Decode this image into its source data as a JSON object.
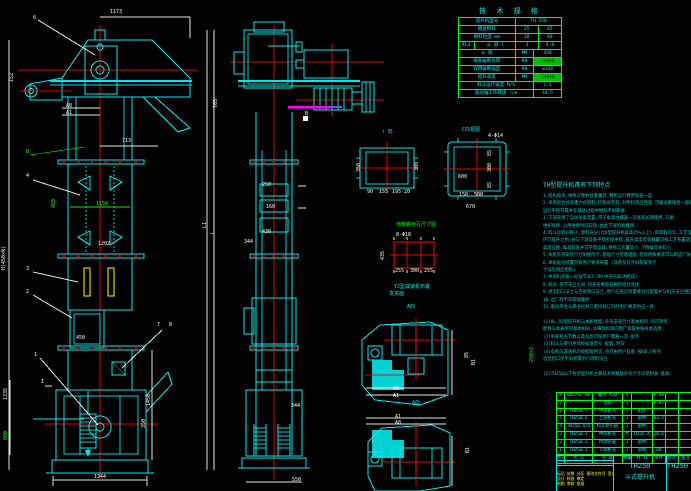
{
  "spec_table": {
    "title": "技 术 规 格",
    "rows": [
      {
        "cells": [
          {
            "t": "提升机型号",
            "f": 5
          },
          {
            "t": "TH 250",
            "f": 4
          }
        ]
      },
      {
        "cells": [
          {
            "t": "输送物料",
            "f": 5
          },
          {
            "t": "25",
            "f": 2
          },
          {
            "t": "45",
            "f": 2
          }
        ]
      },
      {
        "cells": [
          {
            "t": "物料粒度 mm",
            "f": 5
          },
          {
            "t": "30",
            "f": 2
          },
          {
            "t": "40",
            "f": 2
          }
        ]
      },
      {
        "cells": [
          {
            "t": "料斗",
            "f": 1.4
          },
          {
            "t": "斗 容 l",
            "f": 3.6
          },
          {
            "t": "3",
            "f": 2
          },
          {
            "t": "4.8",
            "f": 2
          }
        ]
      },
      {
        "cells": [
          {
            "t": "斗 距",
            "f": 5
          },
          {
            "t": "MM",
            "f": 1.6
          },
          {
            "t": "450",
            "f": 2.4
          }
        ]
      },
      {
        "cells": [
          {
            "t": "链条破断负荷",
            "f": 5
          },
          {
            "t": "KN",
            "f": 1.6
          },
          {
            "t": "25000",
            "f": 2.4,
            "hl": true
          }
        ]
      },
      {
        "cells": [
          {
            "t": "许用破断强度",
            "f": 5
          },
          {
            "t": "KN",
            "f": 1.6
          },
          {
            "t": "≥320",
            "f": 2.4
          }
        ]
      },
      {
        "cells": [
          {
            "t": "提升高度",
            "f": 5
          },
          {
            "t": "MM",
            "f": 1.6
          },
          {
            "t": "14040",
            "f": 2.4,
            "hl": true
          }
        ]
      },
      {
        "cells": [
          {
            "t": "料斗运行速度 M/S",
            "f": 6.6
          },
          {
            "t": "1.2",
            "f": 2.4
          }
        ]
      },
      {
        "cells": [
          {
            "t": "驱动轴工作转速 r/m",
            "f": 6.6
          },
          {
            "t": "44.5",
            "f": 2.4
          }
        ]
      }
    ]
  },
  "notes": {
    "header": "TH型提升机具有下列特点",
    "lines": [
      "1.结构简单,维修方便并且重量轻,整机运行费用较低一些",
      "2.采用混合式或重力式卸料,挖取式装料,对物料适应性强 可输送磨琢性一般的物料,",
      "  运行平稳可靠并在输送过程中物料不易撒漏",
      "3.下部采用了自动张紧装置,带子张紧由螺旋一次张紧长期使用,方便",
      "  维护保养,占用维修时间较短,由此节省检修费用",
      "4.料斗运转间隙小,卸料充分(比D型提升机提高25%以上),装卸料均匀,工艺流程中可作中间",
      "  环节提升之用,并与下游设备平稳衔接中转,提升高度及装载量可按工艺布置选择有较",
      "  高适应性,噪音较低并可平稳运转,维修工作量较小 下降噪音亦较小",
      "5.本机外形安装尺寸如图所示,基础尺寸见基础图,若有特殊要求可与制造厂协商订货",
      "6.本机驱动装置可按用户要求布置            (其余型号外形及安装尺",
      "  寸详见相应图纸)",
      "7.中部机壳每一标准节长2.5M(中部壳高3M组成)",
      "8.机壳 各节法兰之间 均夹有橡胶石棉垫密封连接",
      "9.进出料口法兰与连接管口法兰,用户应按实际需要另行配置并与机壳法兰相匹配连接",
      "10.出厂时不带基础螺栓",
      "11.驱动平台与梯子栏杆二者均按订货时用户要求供应一并",
      "",
      "(1)HL,DZ型提升机与本机性能,外形安装尺寸基本相同 均可参考,",
      "   配件与本表所列基本相同,详细资料请向我厂索取并按样本选用:",
      "(2)中部机壳节数以及总高可按用户需要一次-配齐",
      "(3)料斗与牵引件均按标准型号 配套 供货",
      "(4)电机与减速机均按配套供货,也可由用户自备 按GB,Y系列",
      "   选型后口径不同者需另行改制法兰",
      "",
      "(5)TH250以下各型提升机主要技术参数及外形尺寸详见附表 备索."
    ]
  },
  "parts_table": {
    "col_flex": [
      0.55,
      2.0,
      2.2,
      0.6,
      1.5,
      0.9,
      0.9,
      1.0
    ],
    "rows": [
      [
        "8",
        "GB5782-86",
        "螺栓 M20",
        "4",
        "",
        "0.08",
        "",
        ""
      ],
      [
        "7",
        "",
        "垫圈",
        "1",
        "",
        "0.05",
        "",
        ""
      ],
      [
        "6",
        "TH250.7",
        "中部机壳",
        "1",
        "组焊",
        "",
        "",
        ""
      ],
      [
        "5",
        "TH250.6",
        "上部机壳",
        "1",
        "部件",
        "83.5",
        "",
        ""
      ],
      [
        "4",
        "TH250.4/5",
        "料斗牵引链",
        "1",
        "部件",
        "",
        "",
        ""
      ],
      [
        "3",
        "TH250.3",
        "中间机壳",
        "M",
        "Q235-A",
        "20.6",
        "",
        ""
      ],
      [
        "2",
        "TH250.2",
        "传动装置",
        "1",
        "部件",
        "",
        "",
        ""
      ],
      [
        "1",
        "TH250.1",
        "下部机壳",
        "1",
        "部件",
        "88",
        "",
        ""
      ]
    ],
    "header": [
      "件号",
      "代 号",
      "名 称",
      "数量",
      "材 料",
      "单件",
      "总计",
      "备注"
    ]
  },
  "title_block": {
    "model": "TH250",
    "product": "斗式提升机",
    "right_model": "TH250",
    "rev_row": "标记 处数 分区 更改文件号 签名 日期",
    "sign_row1": "设计  校核  审定",
    "sign_row2": "制图  审核  批准"
  },
  "colors": {
    "line_cyan": "#00e8e8",
    "centerline_red": "#ff0000",
    "accent_green": "#00ff00",
    "accent_yellow": "#ffff00",
    "highlight_magenta": "#ff00ff",
    "background": "#000000"
  },
  "annotations": [
    {
      "x": 33,
      "y": 16,
      "t": "6",
      "c": "w"
    },
    {
      "x": 110,
      "y": 10,
      "t": "1173",
      "c": "w"
    },
    {
      "x": 10,
      "y": 82,
      "t": "152",
      "c": "w",
      "r": 1
    },
    {
      "x": 66,
      "y": 104,
      "t": "A8",
      "c": "w"
    },
    {
      "x": 66,
      "y": 111,
      "t": "A1",
      "c": "w"
    },
    {
      "x": 122,
      "y": 139,
      "t": "713",
      "c": "w"
    },
    {
      "x": 26,
      "y": 150,
      "t": "B",
      "c": "g"
    },
    {
      "x": 26,
      "y": 174,
      "t": "4",
      "c": "w"
    },
    {
      "x": 52,
      "y": 208,
      "t": "450",
      "c": "g",
      "r": 1
    },
    {
      "x": 96,
      "y": 202,
      "t": "1150",
      "c": "g"
    },
    {
      "x": 98,
      "y": 242,
      "t": "1202",
      "c": "w"
    },
    {
      "x": 2,
      "y": 270,
      "t": "H(450×N)",
      "c": "w",
      "r": 1
    },
    {
      "x": 26,
      "y": 267,
      "t": "3",
      "c": "w"
    },
    {
      "x": 26,
      "y": 290,
      "t": "2",
      "c": "w"
    },
    {
      "x": 76,
      "y": 336,
      "t": "450",
      "c": "w"
    },
    {
      "x": 34,
      "y": 353,
      "t": "1",
      "c": "w"
    },
    {
      "x": 157,
      "y": 323,
      "t": "7",
      "c": "w"
    },
    {
      "x": 169,
      "y": 323,
      "t": "8",
      "c": "w"
    },
    {
      "x": 41,
      "y": 380,
      "t": "I",
      "c": "w"
    },
    {
      "x": 4,
      "y": 400,
      "t": "1335",
      "c": "w",
      "r": 1
    },
    {
      "x": 147,
      "y": 406,
      "t": "1450",
      "c": "w",
      "r": 1
    },
    {
      "x": 142,
      "y": 428,
      "t": "350",
      "c": "w",
      "r": 1
    },
    {
      "x": 4,
      "y": 440,
      "t": "800",
      "c": "g",
      "r": 1
    },
    {
      "x": 94,
      "y": 475,
      "t": "1344",
      "c": "w"
    },
    {
      "x": 214,
      "y": 108,
      "t": "765",
      "c": "w",
      "r": 1
    },
    {
      "x": 305,
      "y": 112,
      "t": "B",
      "c": "w"
    },
    {
      "x": 262,
      "y": 183,
      "t": "250",
      "c": "w"
    },
    {
      "x": 266,
      "y": 205,
      "t": "160",
      "c": "w"
    },
    {
      "x": 262,
      "y": 230,
      "t": "430",
      "c": "w"
    },
    {
      "x": 244,
      "y": 240,
      "t": "344",
      "c": "w"
    },
    {
      "x": 203,
      "y": 228,
      "t": "L1",
      "c": "w",
      "r": 1
    },
    {
      "x": 211,
      "y": 234,
      "t": "L",
      "c": "w",
      "r": 1
    },
    {
      "x": 291,
      "y": 404,
      "t": "344",
      "c": "w"
    },
    {
      "x": 292,
      "y": 478,
      "t": "550",
      "c": "w"
    },
    {
      "x": 383,
      "y": 130,
      "t": "Ⅰ 向",
      "c": "c"
    },
    {
      "x": 357,
      "y": 172,
      "t": "350",
      "c": "w",
      "r": 1
    },
    {
      "x": 415,
      "y": 171,
      "t": "300",
      "c": "w",
      "r": 1
    },
    {
      "x": 367,
      "y": 190,
      "t": "90",
      "c": "w"
    },
    {
      "x": 379,
      "y": 190,
      "t": "155",
      "c": "w"
    },
    {
      "x": 392,
      "y": 190,
      "t": "195",
      "c": "w"
    },
    {
      "x": 404,
      "y": 190,
      "t": "20",
      "c": "w"
    },
    {
      "x": 462,
      "y": 128,
      "t": "C向视图",
      "c": "c"
    },
    {
      "x": 488,
      "y": 134,
      "t": "4-Φ14",
      "c": "w"
    },
    {
      "x": 458,
      "y": 175,
      "t": "600",
      "c": "w"
    },
    {
      "x": 488,
      "y": 156,
      "t": "85",
      "c": "w",
      "r": 1
    },
    {
      "x": 488,
      "y": 172,
      "t": "300",
      "c": "w",
      "r": 1
    },
    {
      "x": 488,
      "y": 188,
      "t": "85",
      "c": "w",
      "r": 1
    },
    {
      "x": 459,
      "y": 193,
      "t": "150",
      "c": "w"
    },
    {
      "x": 474,
      "y": 193,
      "t": "500",
      "c": "w"
    },
    {
      "x": 466,
      "y": 205,
      "t": "670",
      "c": "w"
    },
    {
      "x": 396,
      "y": 223,
      "t": "地脚螺栓孔尺寸图",
      "c": "g"
    },
    {
      "x": 396,
      "y": 233,
      "t": "8-Φ18",
      "c": "w"
    },
    {
      "x": 381,
      "y": 260,
      "t": "435",
      "c": "w",
      "r": 1
    },
    {
      "x": 395,
      "y": 269,
      "t": "255",
      "c": "w"
    },
    {
      "x": 410,
      "y": 269,
      "t": "300",
      "c": "w"
    },
    {
      "x": 424,
      "y": 269,
      "t": "255",
      "c": "w"
    },
    {
      "x": 394,
      "y": 285,
      "t": "YJ型减速机布置",
      "c": "c"
    },
    {
      "x": 389,
      "y": 292,
      "t": "发货面",
      "c": "c"
    },
    {
      "x": 407,
      "y": 305,
      "t": "A向",
      "c": "c"
    },
    {
      "x": 393,
      "y": 387,
      "t": "A8",
      "c": "w"
    },
    {
      "x": 393,
      "y": 394,
      "t": "A1",
      "c": "w"
    },
    {
      "x": 465,
      "y": 358,
      "t": "85",
      "c": "w",
      "r": 1
    },
    {
      "x": 472,
      "y": 365,
      "t": "B1",
      "c": "w",
      "r": 1
    },
    {
      "x": 412,
      "y": 401,
      "t": "A向",
      "c": "c"
    },
    {
      "x": 395,
      "y": 415,
      "t": "A1",
      "c": "w"
    },
    {
      "x": 395,
      "y": 421,
      "t": "A8",
      "c": "w"
    },
    {
      "x": 466,
      "y": 453,
      "t": "B1",
      "c": "w",
      "r": 1
    },
    {
      "x": 530,
      "y": 362,
      "t": "250×2",
      "c": "g",
      "r": 1
    }
  ]
}
